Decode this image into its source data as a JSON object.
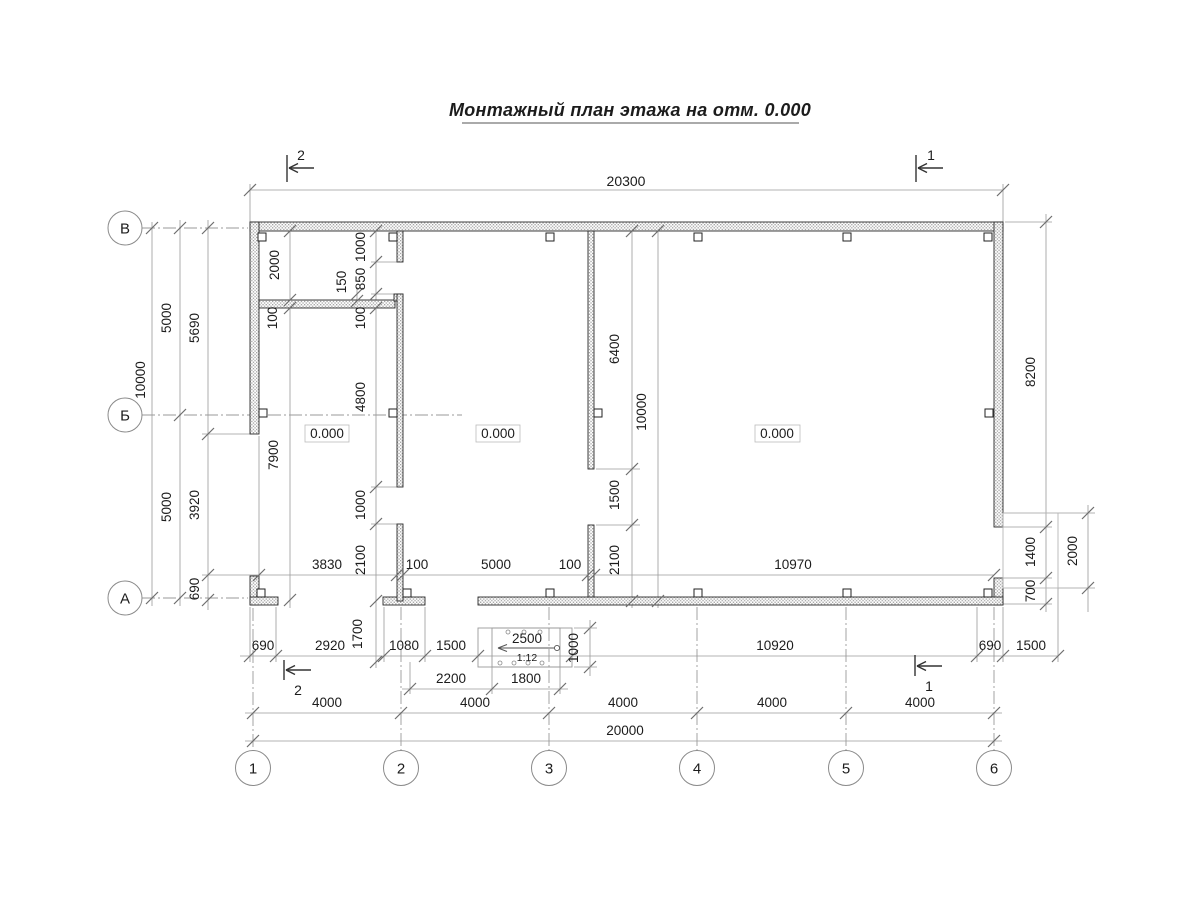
{
  "title": "Монтажный план этажа на отм. 0.000",
  "axes": {
    "columns": [
      "1",
      "2",
      "3",
      "4",
      "5",
      "6"
    ],
    "rows": [
      "В",
      "Б",
      "А"
    ]
  },
  "sections": {
    "one": "1",
    "two": "2"
  },
  "rooms": {
    "elevation": "0.000"
  },
  "ramp": {
    "length": "2500",
    "slope": "1:12"
  },
  "dims": {
    "20300": "20300",
    "20000": "20000",
    "4000": "4000",
    "10000": "10000",
    "5000": "5000",
    "5690": "5690",
    "3920": "3920",
    "690": "690",
    "2000": "2000",
    "100": "100",
    "1000": "1000",
    "850": "850",
    "150": "150",
    "4800": "4800",
    "7900": "7900",
    "2100": "2100",
    "3830": "3830",
    "10970": "10970",
    "6400": "6400",
    "1500": "1500",
    "2920": "2920",
    "1080": "1080",
    "1700": "1700",
    "2200": "2200",
    "1800": "1800",
    "10920": "10920",
    "8200": "8200",
    "1400": "1400",
    "700": "700"
  }
}
